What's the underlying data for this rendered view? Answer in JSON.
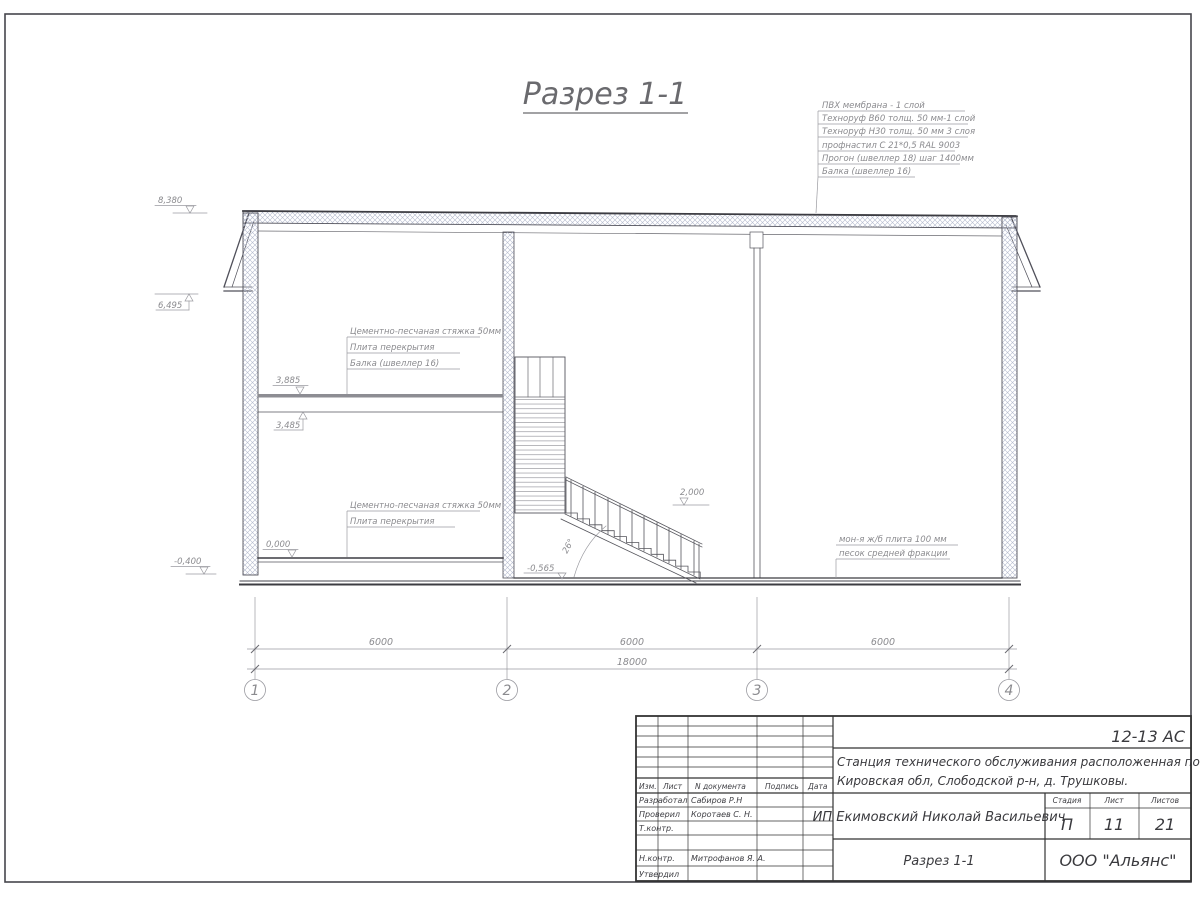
{
  "drawing": {
    "title": "Разрез 1-1",
    "roof_note": [
      "ПВХ мембрана - 1 слой",
      "Техноруф В60 толщ. 50 мм-1 слой",
      "Техноруф Н30 толщ. 50 мм 3 слоя",
      "профнастил С 21*0,5 RAL 9003",
      "Прогон (швеллер 18) шаг 1400мм",
      "Балка (швеллер 16)"
    ],
    "floor2_note": [
      "Цементно-песчаная стяжка 50мм",
      "Плита перекрытия",
      "Балка (швеллер 16)"
    ],
    "floor1_note": [
      "Цементно-песчаная стяжка 50мм",
      "Плита перекрытия"
    ],
    "slab_note": [
      "мон-я ж/б плита 100 мм",
      "песок средней фракции"
    ],
    "levels": {
      "roof": "8,380",
      "eave": "6,495",
      "slab_top": "3,885",
      "slab_bot": "3,485",
      "zero": "0,000",
      "minus400": "-0,400",
      "minus565": "-0,565",
      "landing": "2,000"
    },
    "stair_angle": "26°",
    "dims": {
      "spans": [
        "6000",
        "6000",
        "6000"
      ],
      "total": "18000"
    },
    "grid_axes": [
      "1",
      "2",
      "3",
      "4"
    ]
  },
  "titleblock": {
    "doc_code": "12-13 АС",
    "object_line1": "Станция технического обслуживания расположенная по адресу",
    "object_line2": "Кировская обл, Слободской р-н, д. Трушковы.",
    "client": "ИП Екимовский Николай Васильевич",
    "sheet_title": "Разрез 1-1",
    "company": "ООО \"Альянс\"",
    "stage_label": "Стадия",
    "sheet_label": "Лист",
    "sheets_label": "Листов",
    "stage": "П",
    "sheet": "11",
    "sheets": "21",
    "columns": {
      "izm": "Изм.",
      "list": "Лист",
      "doc": "N документа",
      "sign": "Подпись",
      "date": "Дата"
    },
    "roles": {
      "developed": "Разработал",
      "checked": "Проверил",
      "tcontrol": "Т.контр.",
      "ncontrol": "Н.контр.",
      "approved": "Утвердил"
    },
    "names": {
      "developed": "Сабиров Р.Н",
      "checked": "Коротаев С. Н.",
      "ncontrol": "Митрофанов Я. А."
    }
  }
}
